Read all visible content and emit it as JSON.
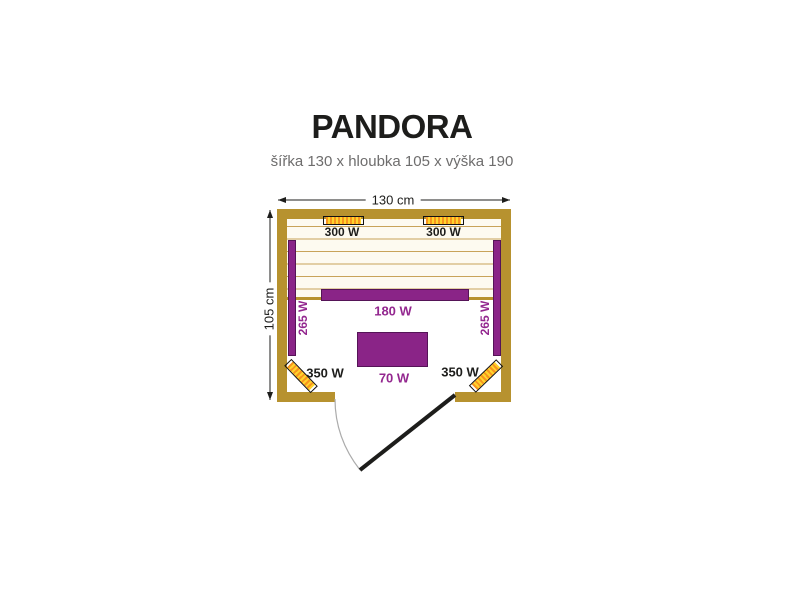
{
  "title": "PANDORA",
  "subtitle": "šířka 130 x hloubka 105 x výška 190",
  "dimensions": {
    "width": "130 cm",
    "depth": "105 cm"
  },
  "labels": {
    "heater_top_left": "300 W",
    "heater_top_right": "300 W",
    "panel_left": "265 W",
    "panel_right": "265 W",
    "bench_front": "180 W",
    "floor_unit": "70 W",
    "corner_left": "350 W",
    "corner_right": "350 W"
  },
  "colors": {
    "wall": "#B7922F",
    "slat_line": "#C8A359",
    "slat_bg": "#FDFAF0",
    "purple": "#8A2487",
    "purple_text": "#93278F",
    "yellow": "#FFD42C",
    "orange": "#F7941E",
    "ink": "#1D1D1B",
    "gray_text": "#6E6D6D",
    "door_arc": "#ABABAB"
  }
}
